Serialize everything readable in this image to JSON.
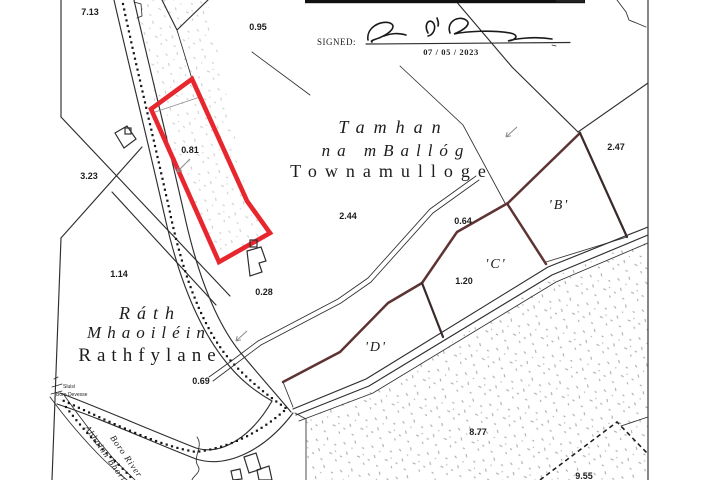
{
  "colors": {
    "highlight_red": "#e8262d",
    "parcel_boundary_brown": "#5e3333",
    "ink": "#2e2e2e",
    "stipple_gray": "#9b9b9b"
  },
  "signed_block": {
    "label": "SIGNED:",
    "date": "07 / 05 / 2023"
  },
  "townlands": {
    "center": {
      "irish_line1": "Tamhan",
      "irish_line2": "na mBallóg",
      "english": "Townamulloge"
    },
    "west": {
      "irish_line1": "Ráth",
      "irish_line2": "Mhaoiléin",
      "english": "Rathfylane"
    }
  },
  "parcel_letters": {
    "b": "'B'",
    "c": "'C'",
    "d": "'D'"
  },
  "area_labels": {
    "a713": "7.13",
    "a095": "0.95",
    "a323": "3.23",
    "a081": "0.81",
    "a244": "2.44",
    "a064": "0.64",
    "a247": "2.47",
    "a114": "1.14",
    "a028": "0.28",
    "a120": "1.20",
    "a069": "0.69",
    "a877": "8.77",
    "a955": "9.55"
  },
  "river": {
    "irish": "Abhainn Bhoru",
    "english": "Boro River"
  },
  "micro_labels": {
    "line1": "Sluisí",
    "line2": "Boro Devesse"
  }
}
